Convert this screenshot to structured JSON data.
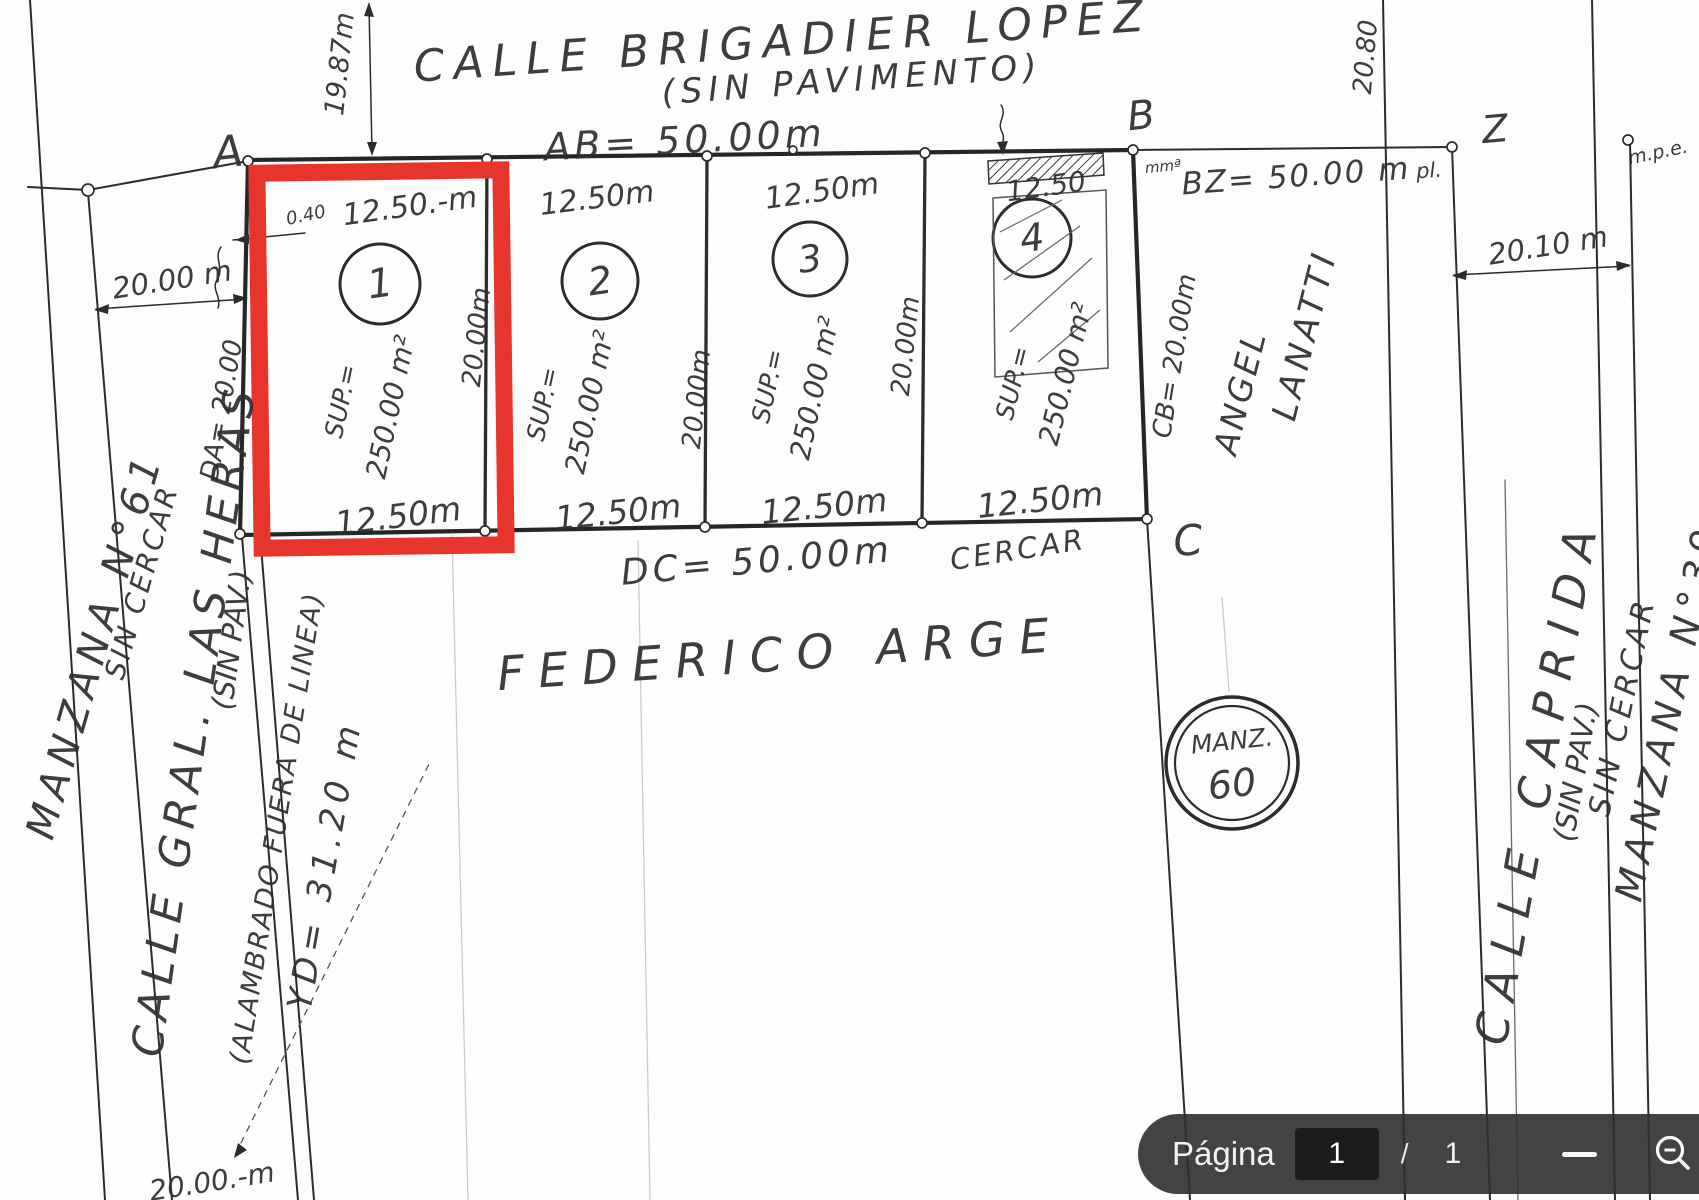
{
  "toolbar": {
    "page_label": "Página",
    "page_value": "1",
    "page_divider": "/",
    "page_total": "1"
  },
  "drawing": {
    "streets": {
      "top": "CALLE BRIGADIER LOPEZ",
      "top_note": "(SIN PAVIMENTO)",
      "left": "CALLE GRAL. LAS HERAS",
      "left_note": "(SIN PAV.)",
      "right": "CALLE CAPRIDA",
      "right_note": "(SIN PAV.)"
    },
    "blocks": {
      "left_name": "MANZANA N°61",
      "left_note": "SIN CERCAR",
      "right_name": "MANZANA N°39",
      "right_note": "SIN CERCAR",
      "center_label": "MANZ.",
      "center_number": "60"
    },
    "names": {
      "south_owner": "FEDERICO ARGE",
      "east_owner_first_name": "ANGEL",
      "east_owner_last_name": "LANATTI"
    },
    "corners": {
      "a": "A",
      "b": "B",
      "c": "C",
      "z": "Z"
    },
    "dims": {
      "ab": "AB= 50.00m",
      "bz": "BZ= 50.00 m",
      "bz_note": "pl.",
      "dc": "DC= 50.00m",
      "da": "DA= 20.00",
      "cb": "CB= 20.00m",
      "west_frontage": "20.00 m",
      "west_depth": "19.87m",
      "east_frontage": "20.10 m",
      "east_depth": "20.80",
      "yd": "YD= 31.20 m",
      "offset": "0.40",
      "southwest_frontage": "20.00.-m",
      "fence_note": "(ALAMBRADO FUERA DE LINEA)",
      "cercar": "CERCAR",
      "mpe": "m.p.e.",
      "scribble": "mmª"
    },
    "lots": [
      {
        "number": "1",
        "front": "12.50.-m",
        "back": "12.50m",
        "side": "20.00m",
        "sup_label": "SUP.=",
        "sup_value": "250.00 m²"
      },
      {
        "number": "2",
        "front": "12.50m",
        "back": "12.50m",
        "side": "20.00m",
        "sup_label": "SUP.=",
        "sup_value": "250.00 m²"
      },
      {
        "number": "3",
        "front": "12.50m",
        "back": "12.50m",
        "side": "20.00m",
        "sup_label": "SUP.=",
        "sup_value": "250.00 m²"
      },
      {
        "number": "4",
        "front": "12.50",
        "back": "12.50m",
        "sup_label": "SUP.=",
        "sup_value": "250.00 m²"
      }
    ]
  },
  "colors": {
    "highlight_red": "#e8352b",
    "ink": "#2f2f2f",
    "toolbar_bg": "#2f2f2f"
  }
}
